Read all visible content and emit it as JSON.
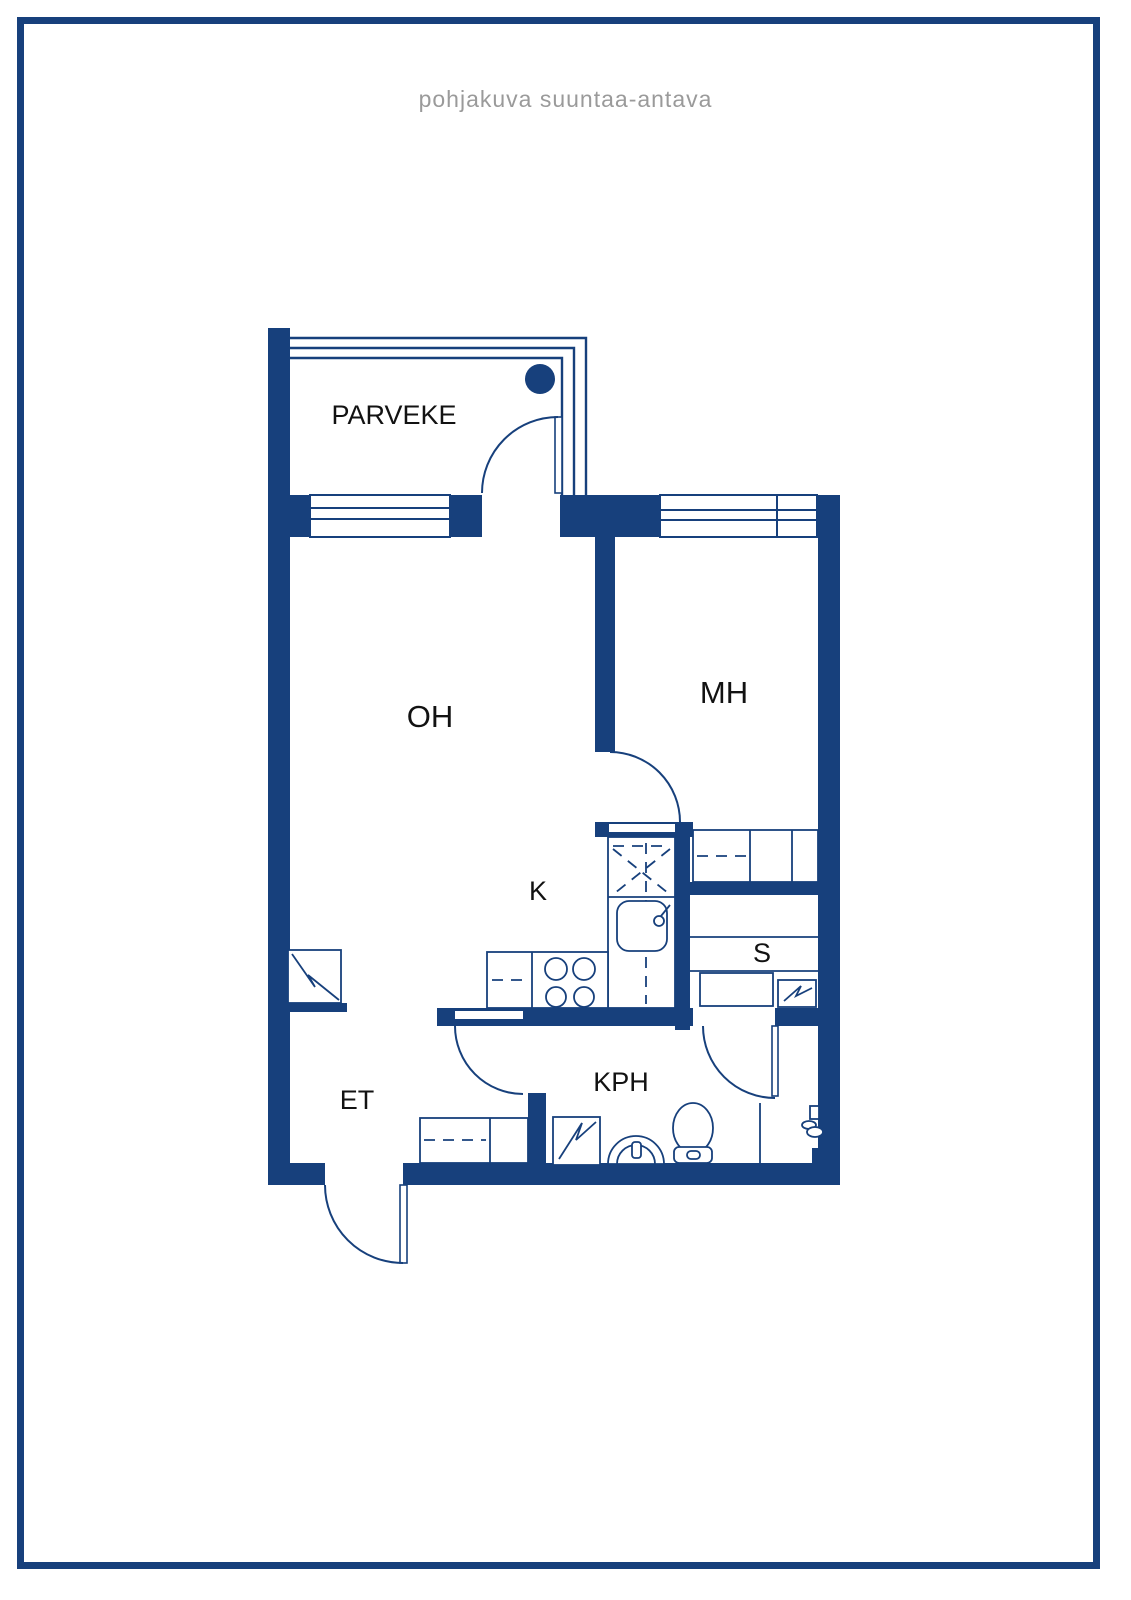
{
  "page": {
    "title": "pohjakuva suuntaa-antava"
  },
  "colors": {
    "wall_navy": "#17407C",
    "title_gray": "#9A9A9A",
    "label_black": "#121212",
    "background": "#FFFFFF"
  },
  "rooms": [
    {
      "id": "parveke",
      "label": "PARVEKE"
    },
    {
      "id": "oh",
      "label": "OH"
    },
    {
      "id": "mh",
      "label": "MH"
    },
    {
      "id": "k",
      "label": "K"
    },
    {
      "id": "s",
      "label": "S"
    },
    {
      "id": "et",
      "label": "ET"
    },
    {
      "id": "kph",
      "label": "KPH"
    }
  ]
}
